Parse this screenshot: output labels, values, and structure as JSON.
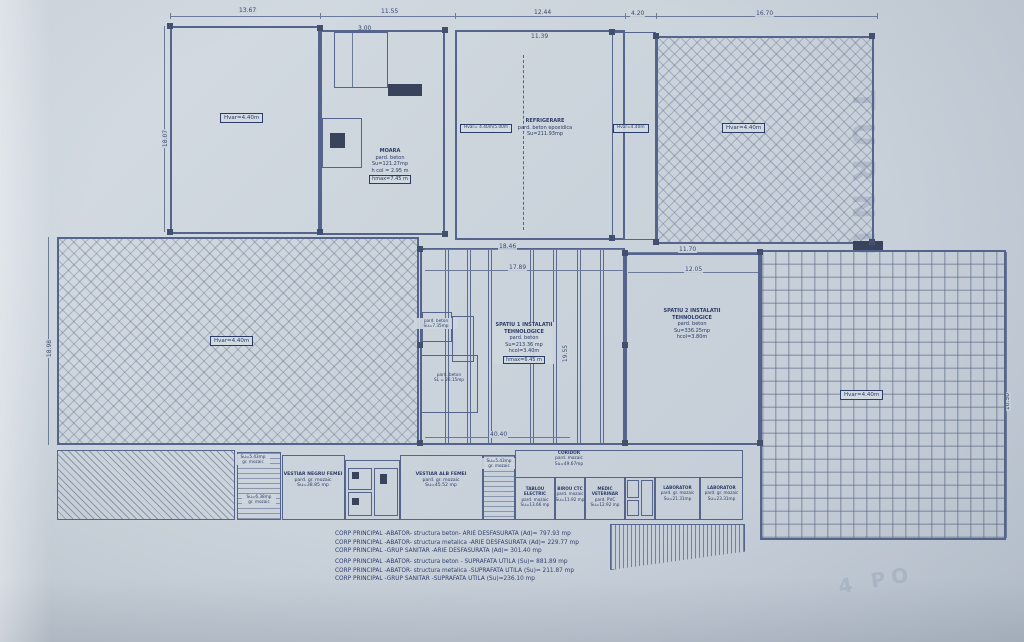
{
  "legend": {
    "lines": [
      "CORP PRINCIPAL -ABATOR- structura beton- ARIE DESFASURATA (Ad)= 797.93 mp",
      "CORP PRINCIPAL -ABATOR- structura metalica -ARIE DESFASURATA (Ad)= 229.77 mp",
      "CORP PRINCIPAL -GRUP SANITAR -ARIE DESFASURATA (Ad)= 301.40 mp",
      "CORP PRINCIPAL -ABATOR- structura beton - SUPRAFATA UTILA (Su)= 881.89 mp",
      "CORP PRINCIPAL -ABATOR- structura metalica -SUPRAFATA UTILA (Su)= 211.87 mp",
      "CORP PRINCIPAL -GRUP SANITAR -SUPRAFATA UTILA (Su)=236.10 mp"
    ]
  },
  "rooms": {
    "hall_top_left": {
      "badge": "Hvar=4.40m"
    },
    "moara": {
      "name": "MOARA",
      "floor": "pard. beton",
      "area": "Su=121.27mp",
      "hcol": "h col = 2.95 m",
      "hmax": "hmax=7.45 m"
    },
    "refrigerare": {
      "name": "REFRIGERARE",
      "floor": "pard. beton epoxidica",
      "area": "Su=211.93mp",
      "badge_left": "Hvar= 4.40m/5.00m",
      "badge_right": "Hvar=4.40m"
    },
    "platform_top_right": {
      "badge": "Hvar=4.40m"
    },
    "platform_left": {
      "badge": "Hvar=4.40m"
    },
    "platform_right": {
      "badge": "Hvar=4.40m"
    },
    "spatiu1": {
      "name": "SPATIU 1 INSTALATII",
      "name2": "TEHNOLOGICE",
      "floor": "pard. beton",
      "area": "Su=213.36 mp",
      "hcol": "hcol=3.40m",
      "hmax": "hmax=6.45 m"
    },
    "spatiu2": {
      "name": "SPATIU 2 INSTALATII",
      "name2": "TEHNOLOGICE",
      "floor": "pard. beton",
      "area": "Su=336.25mp",
      "hcol": "hcol=3.80m"
    },
    "small_a": {
      "floor": "pard. beton",
      "area": "Su=7.35mp"
    },
    "small_b": {
      "floor": "pard. beton",
      "area": "SL = 26.15mp"
    },
    "vestiar_negru": {
      "name": "VESTIAR NEGRU FEMEI",
      "floor": "pard. gr. mozaic",
      "area": "Su=38.85 mp"
    },
    "vestiar_alb": {
      "name": "VESTIAR ALB FEMEI",
      "floor": "pard. gr. mozaic",
      "area": "Su=45.52 mp"
    },
    "coridor": {
      "name": "CORIDOR",
      "floor": "pard. mozaic",
      "area": "Su=49.67mp"
    },
    "tablou": {
      "name": "TABLOU ELECTRIC",
      "floor": "pard. mozaic",
      "area": "Su=13.66 mp"
    },
    "birou": {
      "name": "BIROU CTC",
      "floor": "pard. mozaic",
      "area": "Su=11.92 mp"
    },
    "medic": {
      "name": "MEDIC VETERINAR",
      "floor": "pard. PVC",
      "area": "Su=12.92 mp"
    },
    "lab1": {
      "name": "LABORATOR",
      "floor": "pard. gr. mozaic",
      "area": "Su=21.31mp"
    },
    "lab2": {
      "name": "LABORATOR",
      "floor": "pard. gr. mozaic",
      "area": "Su=23.31mp"
    },
    "stair_left": {
      "l1": "Su=5.43mp",
      "l2": "gr. mozaic"
    },
    "stair_left2": {
      "l1": "Su=6.38mp",
      "l2": "gr. mozaic"
    },
    "stair_mid": {
      "l1": "Su=5.43mp",
      "l2": "gr. mozaic"
    }
  },
  "dims": {
    "t1": "13.67",
    "t2": "11.55",
    "t3": "12.44",
    "t4": "4.20",
    "t5": "16.70",
    "i1": "3.00",
    "i2": "11.39",
    "m1": "18.46",
    "m2": "17.89",
    "m3": "11.70",
    "m4": "12.05",
    "m5": "40.40",
    "v1": "18.07",
    "v2": "18.98",
    "v3": "19.55",
    "v4": "10.50"
  },
  "watermark": {
    "side": "TURNU",
    "corner": "4 PO"
  }
}
